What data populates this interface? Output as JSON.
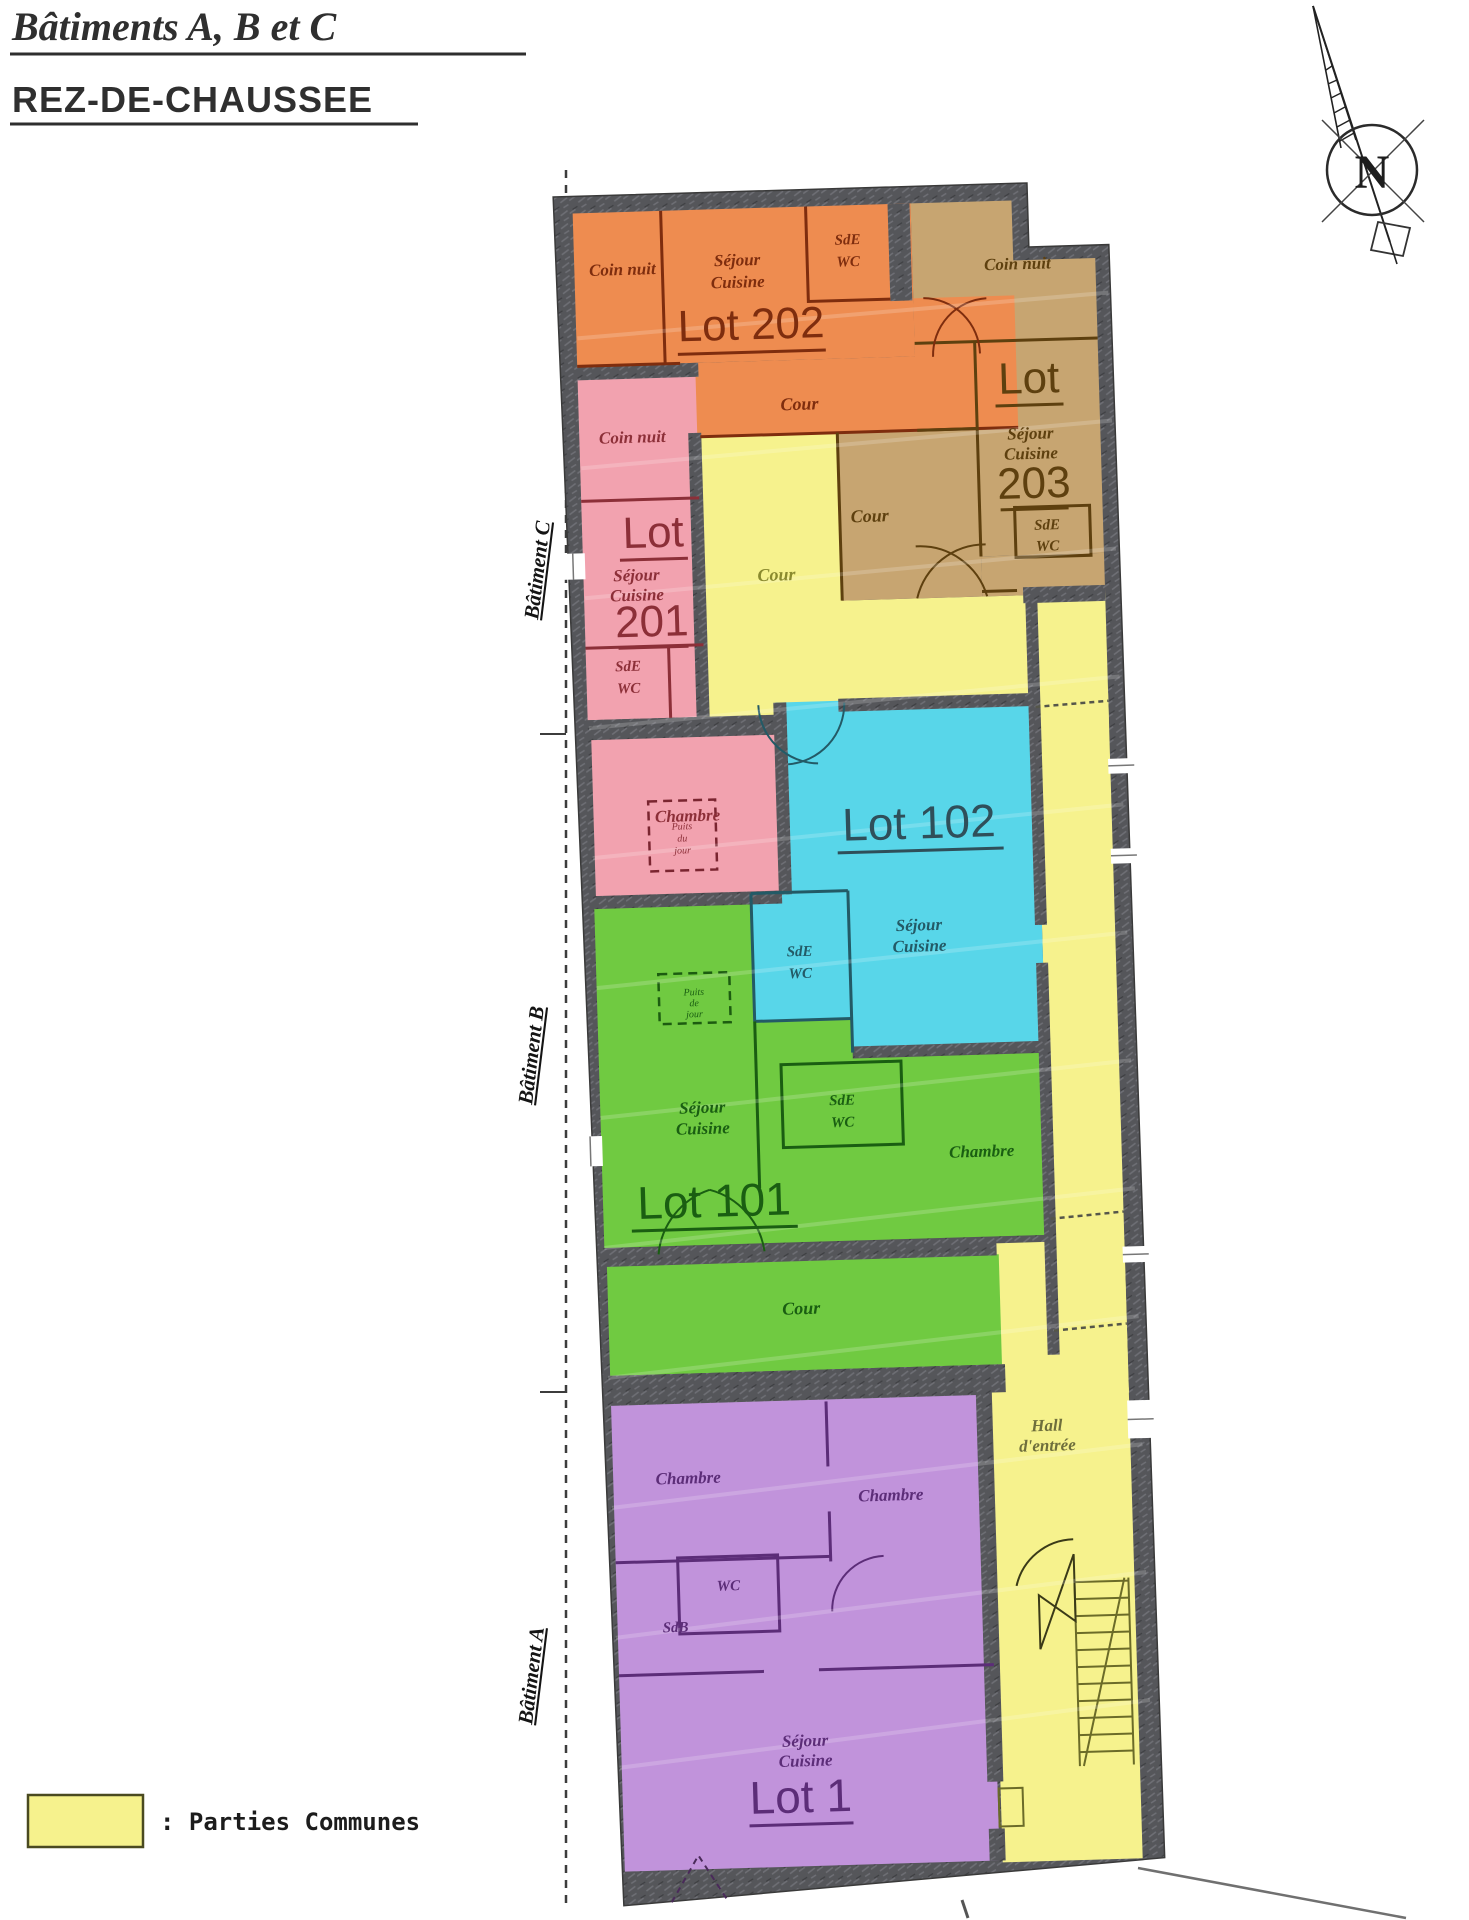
{
  "title": {
    "line1": "Bâtiments A, B et C",
    "line2": "REZ-DE-CHAUSSEE"
  },
  "compass": {
    "north": "N"
  },
  "side_labels": {
    "batiment_c": "Bâtiment C",
    "batiment_b": "Bâtiment B",
    "batiment_a": "Bâtiment A"
  },
  "legend": {
    "label": ": Parties Communes",
    "swatch_color": "#F6F28D"
  },
  "colors": {
    "parties_communes": "#F6F28D",
    "lot202": "#EE8C50",
    "lot203": "#C7A571",
    "lot201": "#F2A2AF",
    "lot102": "#58D6E9",
    "lot101": "#70CA41",
    "lot1": "#C193DB",
    "walls": "#55565A"
  },
  "common": {
    "cour_central": "Cour",
    "hall_line1": "Hall",
    "hall_line2": "d'entrée"
  },
  "lot202": {
    "name": "Lot 202",
    "coin_nuit": "Coin nuit",
    "sejour": "Séjour",
    "cuisine": "Cuisine",
    "sde": "SdE",
    "wc": "WC",
    "cour": "Cour"
  },
  "lot203": {
    "lot": "Lot",
    "num": "203",
    "coin_nuit": "Coin nuit",
    "sejour": "Séjour",
    "cuisine": "Cuisine",
    "sde": "SdE",
    "wc": "WC",
    "cour": "Cour"
  },
  "lot201": {
    "lot": "Lot",
    "num": "201",
    "coin_nuit": "Coin nuit",
    "sejour": "Séjour",
    "cuisine": "Cuisine",
    "sde": "SdE",
    "wc": "WC",
    "chambre": "Chambre",
    "puits_l1": "Puits",
    "puits_l2": "du",
    "puits_l3": "jour"
  },
  "lot102": {
    "name": "Lot 102",
    "sejour": "Séjour",
    "cuisine": "Cuisine",
    "sde": "SdE",
    "wc": "WC"
  },
  "lot101": {
    "name": "Lot 101",
    "sejour": "Séjour",
    "cuisine": "Cuisine",
    "sde": "SdE",
    "wc": "WC",
    "chambre": "Chambre",
    "cour": "Cour",
    "puits_l1": "Puits",
    "puits_l2": "de",
    "puits_l3": "jour"
  },
  "lot1": {
    "name": "Lot 1",
    "chambre_left": "Chambre",
    "chambre_right": "Chambre",
    "wc": "WC",
    "sdb": "SdB",
    "sejour": "Séjour",
    "cuisine": "Cuisine"
  }
}
